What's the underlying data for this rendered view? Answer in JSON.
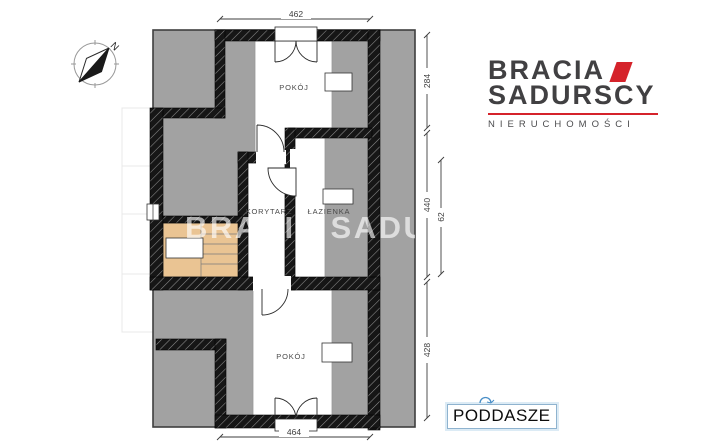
{
  "watermark": {
    "text": "BRACIA SADU"
  },
  "logo": {
    "line1": "BRACIA",
    "line2": "SADURSCY",
    "tagline": "NIERUCHOMOŚCI",
    "accent_color": "#d5232b",
    "text_color": "#414042"
  },
  "floor_label": {
    "text": "PODDASZE"
  },
  "compass": {
    "label": "N"
  },
  "plan": {
    "rooms": [
      {
        "label": "POKÓJ"
      },
      {
        "label": "KORYTARZ"
      },
      {
        "label": "ŁAZIENKA"
      },
      {
        "label": "POKÓJ"
      }
    ],
    "dimensions": {
      "top": "462",
      "bottom": "464",
      "right_upper": "284",
      "right_middle": "440",
      "right_inner": "62",
      "right_lower": "428"
    },
    "colors": {
      "area_gray": "#a2a2a2",
      "stairs_tan": "#eac493",
      "wall_black": "#161616"
    }
  }
}
